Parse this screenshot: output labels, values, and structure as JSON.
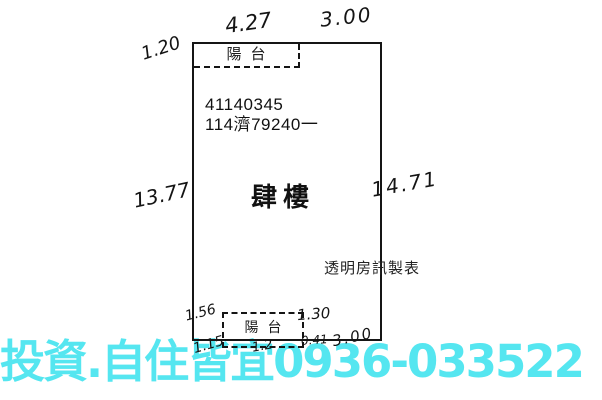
{
  "plan": {
    "document_number": "41140345",
    "case_number": "114濟79240一",
    "floor_label": "肆樓",
    "source_label": "透明房訊製表",
    "top_balcony": {
      "label": "陽台"
    },
    "bottom_balcony": {
      "label": "陽台"
    },
    "measurements": {
      "top_balcony_width": "4.27",
      "top_right_width": "3.00",
      "top_left_depth": "1.20",
      "left_side": "13.77",
      "right_side": "14.71",
      "bottom_balcony_left_depth": "1.56",
      "bottom_balcony_right_depth": "1.30",
      "bottom_offset": "0.41",
      "bottom_right_width": "3.00",
      "bottom_left_partial": "1.15",
      "bottom_mid_partial": "1.2"
    }
  },
  "watermark": {
    "text": "投資.自住皆宜0936-033522",
    "color": "#55e6f0"
  },
  "colors": {
    "ink": "#151515",
    "background": "#ffffff",
    "watermark": "#55e6f0"
  }
}
